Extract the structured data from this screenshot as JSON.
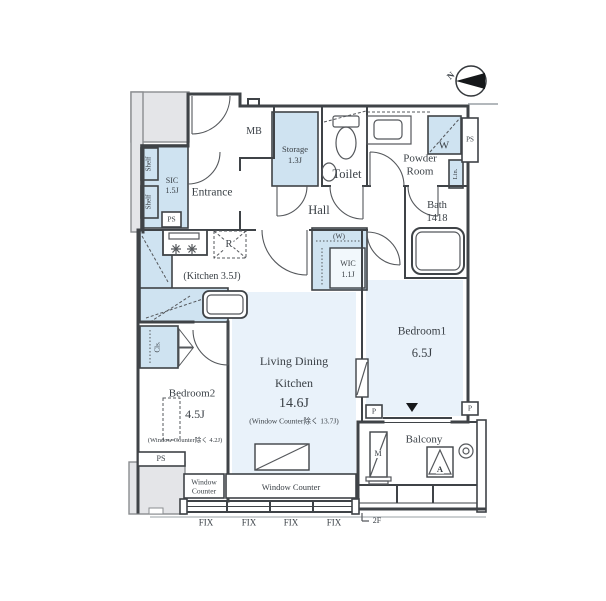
{
  "plan": {
    "compass_label": "N",
    "floor_label": "2F",
    "rooms": {
      "entrance": "Entrance",
      "hall": "Hall",
      "toilet": "Toilet",
      "powder_room": [
        "Powder",
        "Room"
      ],
      "bath": {
        "name": "Bath",
        "size": "1418"
      },
      "storage": {
        "name": "Storage",
        "size": "1.3J"
      },
      "sic": {
        "name": "SIC",
        "size": "1.5J"
      },
      "wic": {
        "name": "WIC",
        "size": "1.1J",
        "note": "(W)"
      },
      "kitchen": "(Kitchen 3.5J)",
      "ldk": {
        "line1": "Living Dining",
        "line2": "Kitchen",
        "size": "14.6J",
        "note": "(Window Counter除く 13.7J)"
      },
      "bedroom1": {
        "name": "Bedroom1",
        "size": "6.5J"
      },
      "bedroom2": {
        "name": "Bedroom2",
        "size": "4.5J",
        "note": "(Window Counter除く 4.2J)"
      },
      "balcony": "Balcony"
    },
    "fixtures": {
      "mb": "MB",
      "ps": "PS",
      "w": "W",
      "lin": "Lin.",
      "r": "R",
      "cls": "Cls.",
      "shelf": "Shelf",
      "m": "M",
      "a": "A",
      "p": "P"
    },
    "window_counter_small": [
      "Window",
      "Counter"
    ],
    "window_counter_large": "Window Counter",
    "fix_labels": [
      "FIX",
      "FIX",
      "FIX",
      "FIX"
    ]
  },
  "colors": {
    "wall": "#3f4347",
    "closet_fill": "#cfe3f1",
    "room_fill": "#e9f2fa",
    "common_fill": "#e4e5e8"
  }
}
